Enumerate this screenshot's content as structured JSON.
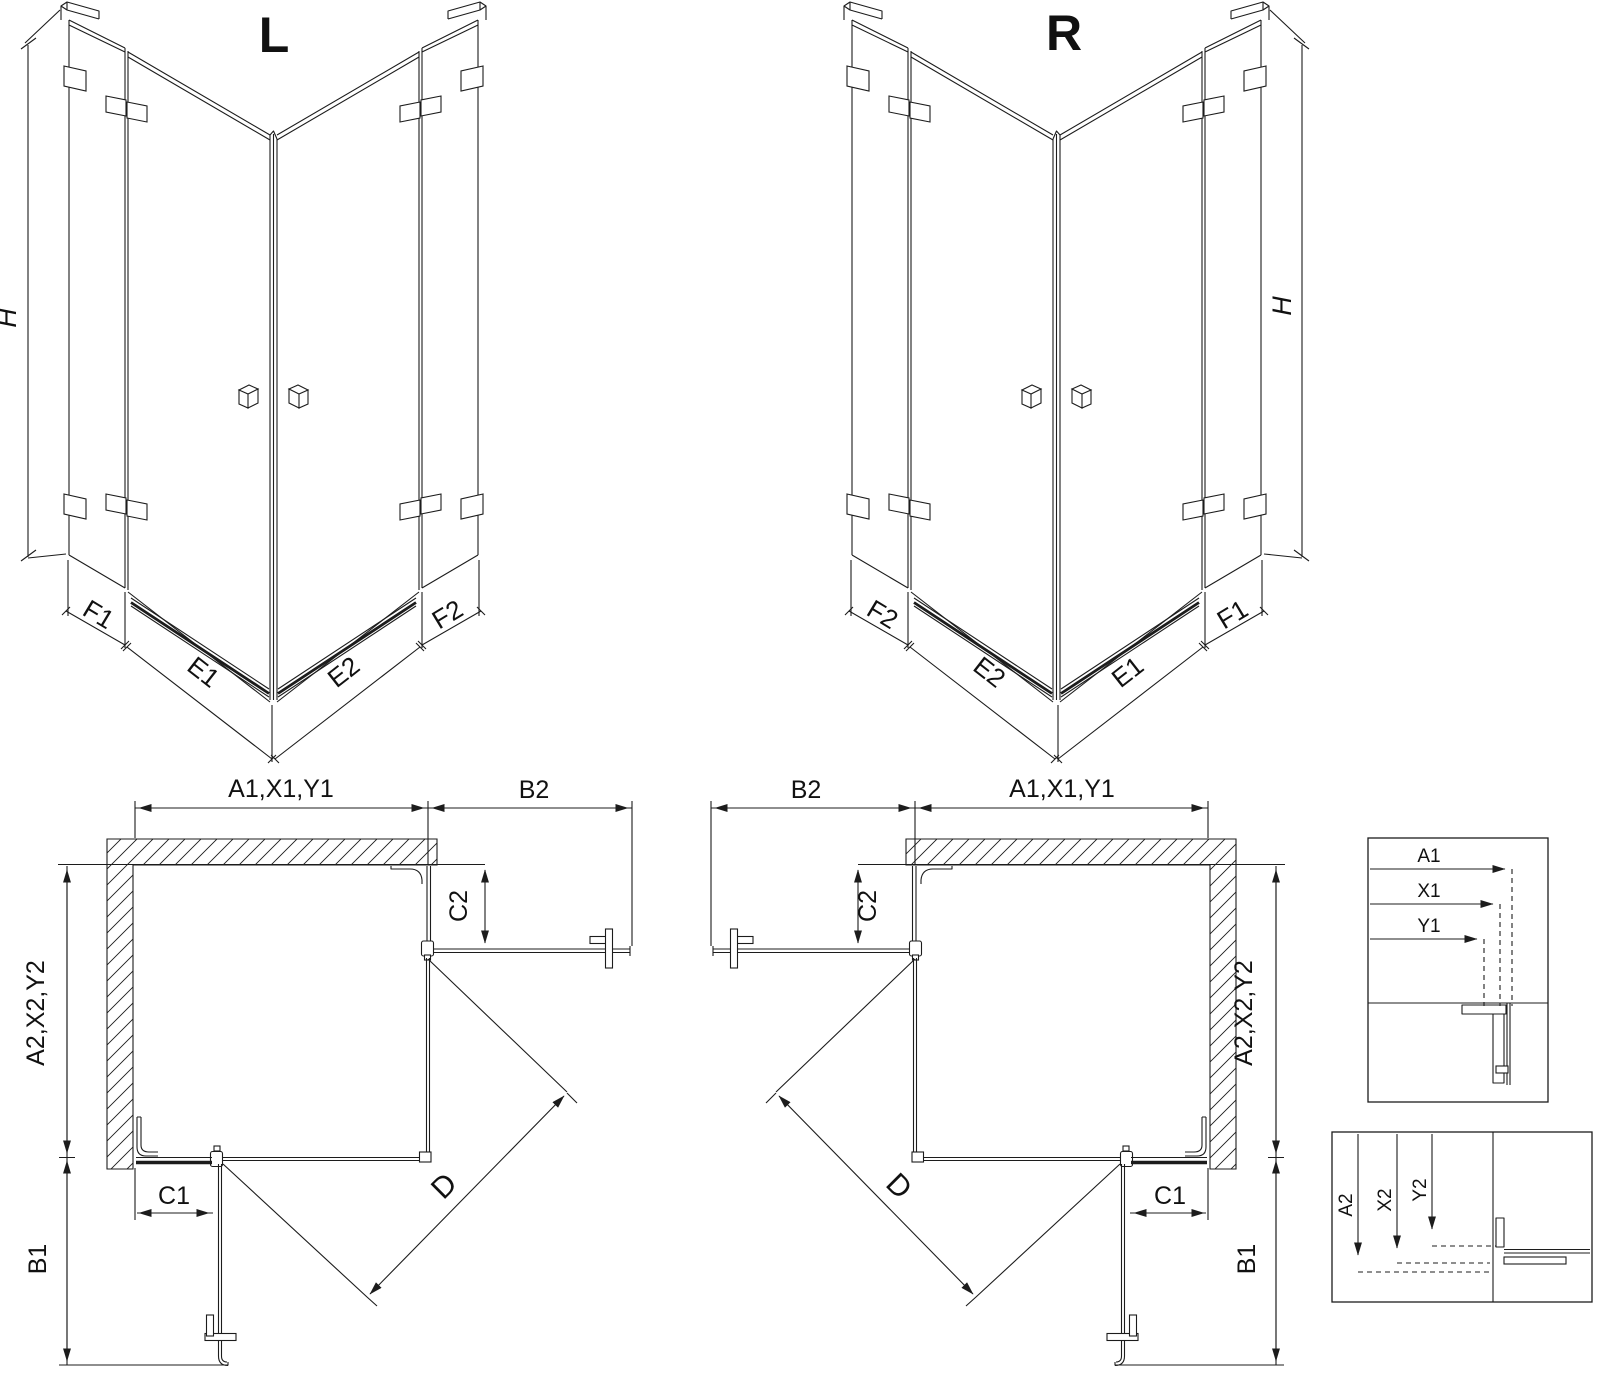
{
  "colors": {
    "line": "#1c1c1c",
    "background": "#ffffff"
  },
  "iso_left": {
    "title": "L",
    "h": "H",
    "f1": "F1",
    "e1": "E1",
    "e2": "E2",
    "f2": "F2"
  },
  "iso_right": {
    "title": "R",
    "h": "H",
    "f2": "F2",
    "e2": "E2",
    "e1": "E1",
    "f1": "F1"
  },
  "plan_left": {
    "top": "A1,X1,Y1",
    "b2": "B2",
    "c2": "C2",
    "a2": "A2,X2,Y2",
    "c1": "C1",
    "b1": "B1",
    "d": "D"
  },
  "plan_right": {
    "top": "A1,X1,Y1",
    "b2": "B2",
    "c2": "C2",
    "a2": "A2,X2,Y2",
    "c1": "C1",
    "b1": "B1",
    "d": "D"
  },
  "detail_top": {
    "a1": "A1",
    "x1": "X1",
    "y1": "Y1"
  },
  "detail_bottom": {
    "a2": "A2",
    "x2": "X2",
    "y2": "Y2"
  }
}
